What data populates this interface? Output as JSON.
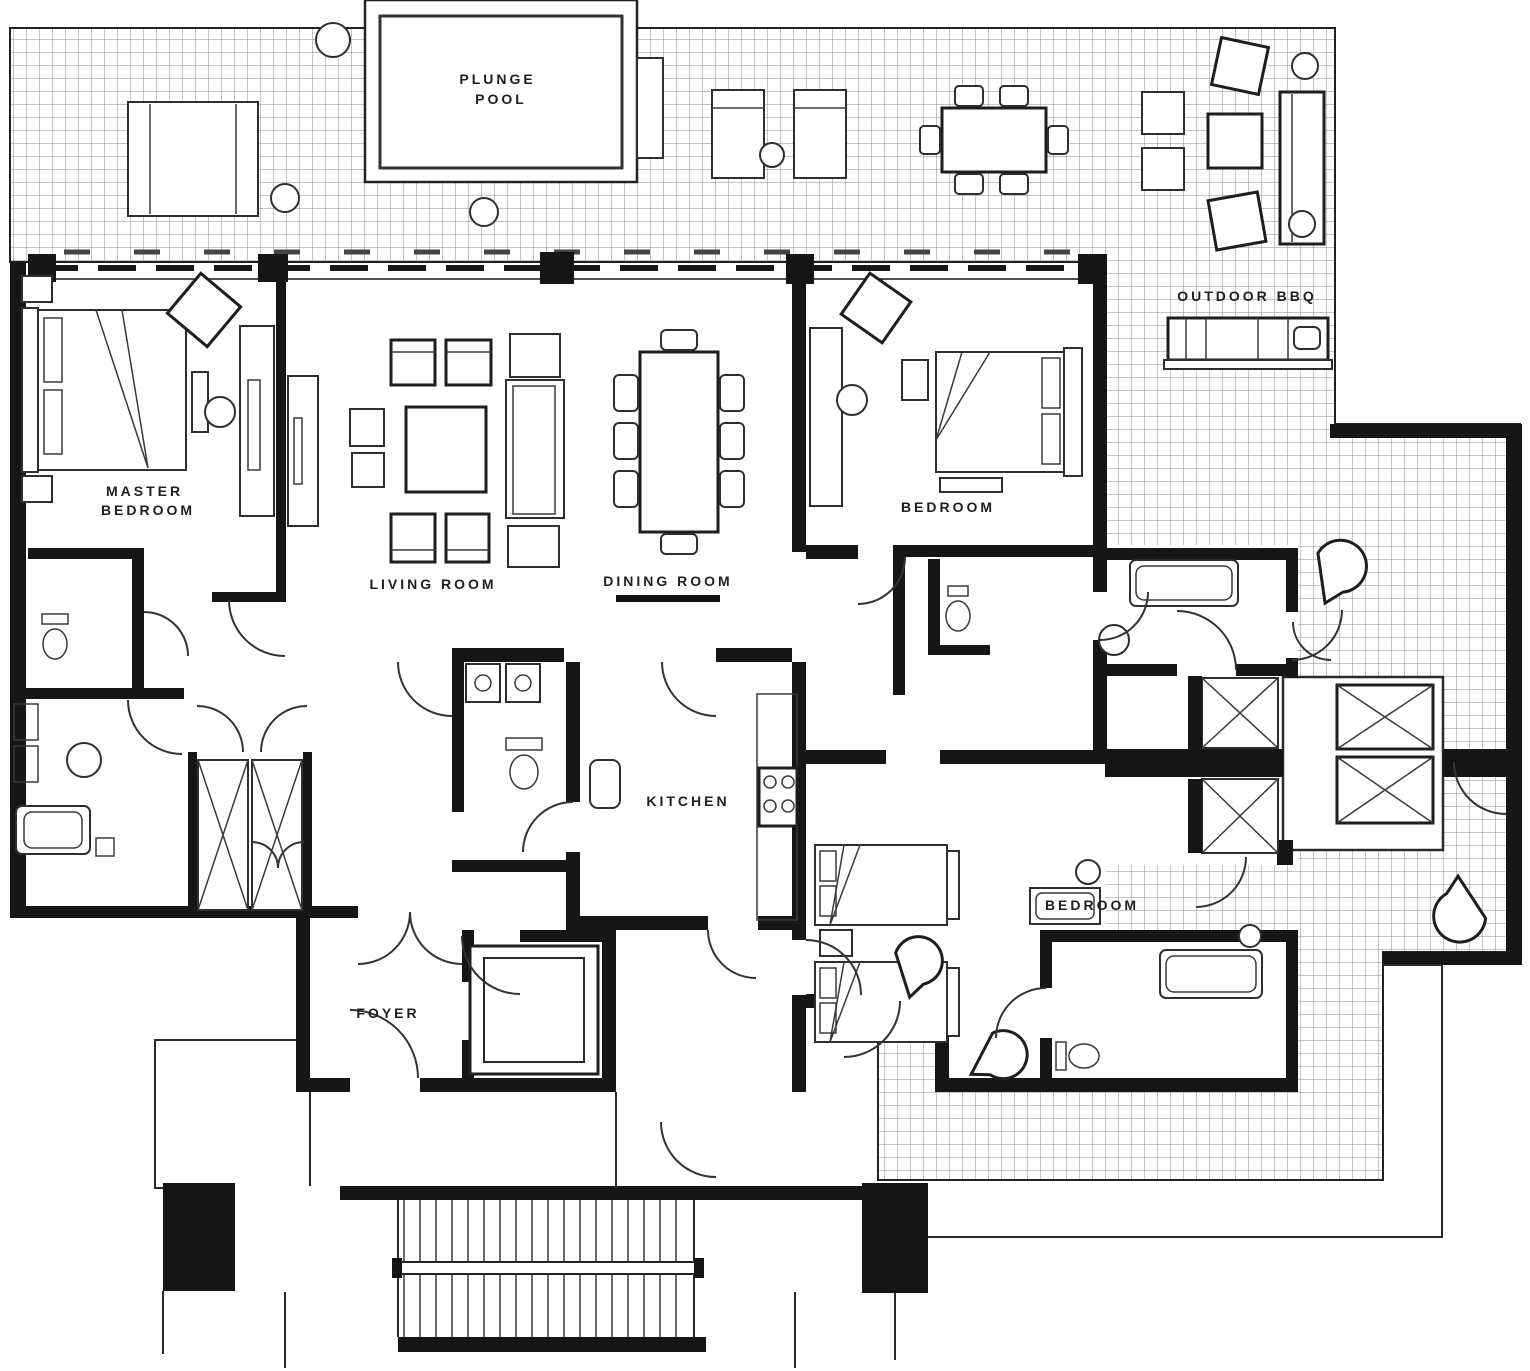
{
  "title": "Penthouse suite floor plan",
  "colors": {
    "ink": "#161616",
    "paper": "#ffffff",
    "tile_grid_line": "#8b8b8b",
    "label_text": "#1f1f1f"
  },
  "rooms": {
    "plunge_pool": {
      "line1": "PLUNGE",
      "line2": "POOL"
    },
    "master_bedroom": {
      "line1": "MASTER",
      "line2": "BEDROOM"
    },
    "living_room": {
      "label": "LIVING ROOM"
    },
    "dining_room": {
      "label": "DINING ROOM"
    },
    "bedroom_top": {
      "label": "BEDROOM"
    },
    "outdoor_bbq": {
      "label": "OUTDOOR BBQ"
    },
    "kitchen": {
      "label": "KITCHEN"
    },
    "foyer": {
      "label": "FOYER"
    },
    "bedroom_bottom": {
      "label": "BEDROOM"
    }
  }
}
